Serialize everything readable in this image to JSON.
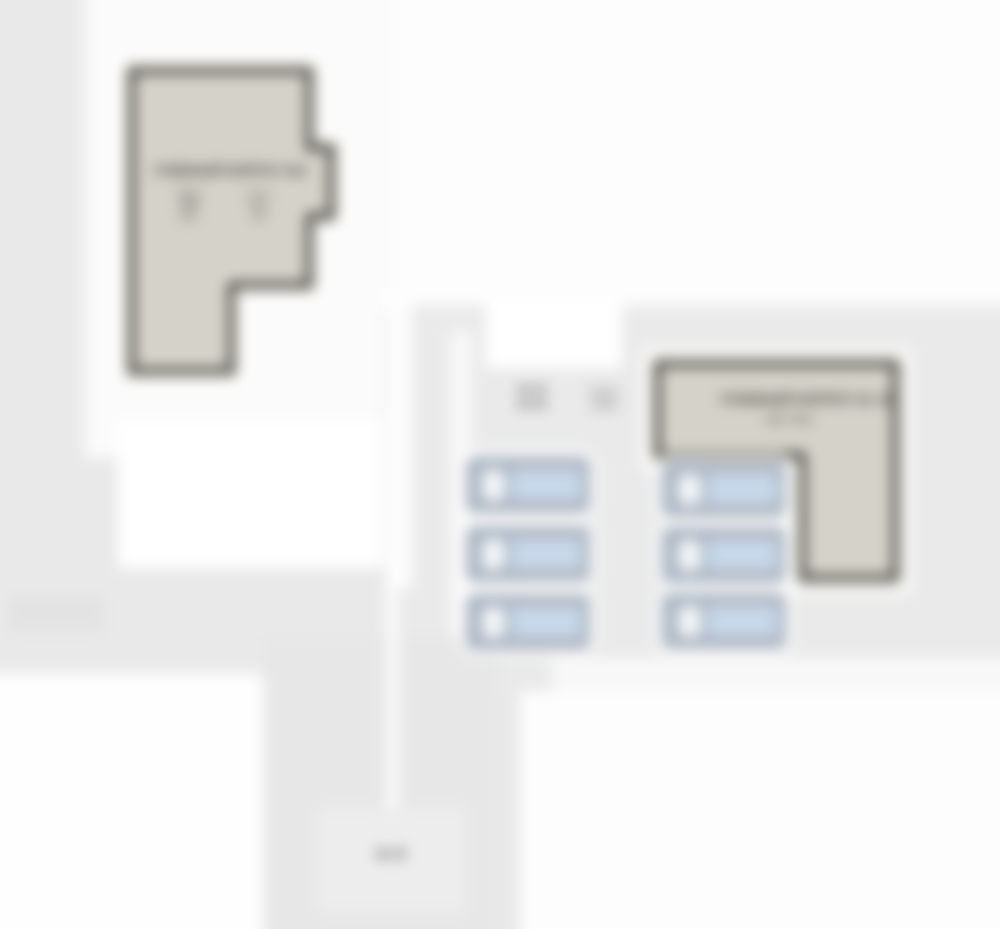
{
  "colors": {
    "bg": "#e9e9e9",
    "right_panel": "#eaeaea",
    "plaza_white": "#ffffff",
    "sector_platform": "#e7e7e7",
    "sector_label_box": "#ededed",
    "building_fill": "#d5d3c9",
    "building_inner": "#e4e2d8",
    "building_edge": "#3f3e3a",
    "bed_body": "#a9b5c3",
    "bed_blanket": "#c7d8ea",
    "bed_pillow": "#f4f6f8",
    "text": "#2f2f2d"
  },
  "left_building": {
    "title": "УЧЕБНЫЙ КОРПУС №2",
    "note_left": [
      "№ 21",
      "1956",
      "3 эт."
    ],
    "note_right": [
      "24×12",
      "кирп.",
      "ж/б"
    ]
  },
  "right_building": {
    "title": "ГЛАВНЫЙ КОРПУС № 12",
    "subtitle": "два этажа"
  },
  "parking_info": {
    "left": [
      "№ 12",
      "№ 10"
    ],
    "right": [
      "8 мест",
      "6 мест"
    ]
  },
  "sector_label": "А-II",
  "beds": {
    "left_column_count": 3,
    "right_column_count": 3
  }
}
